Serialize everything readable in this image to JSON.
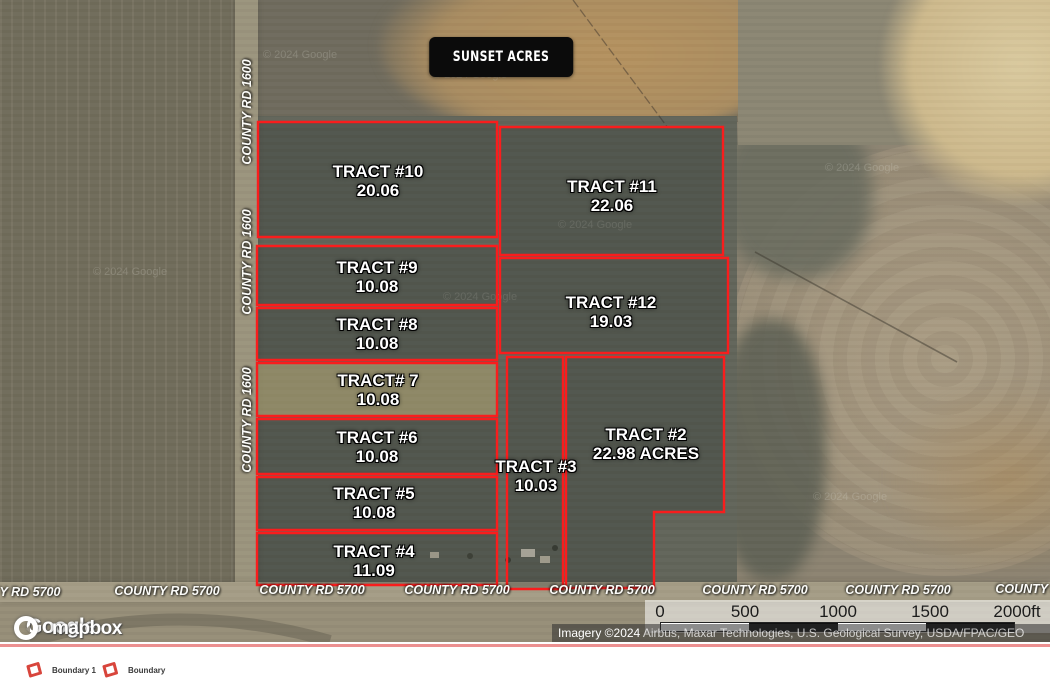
{
  "map": {
    "badge": "SUNSET ACRES",
    "boundary_color": "#f91d1d",
    "watermark_text": "© 2024 Google",
    "tracts": [
      {
        "name": "TRACT #10",
        "acres": "20.06",
        "cx": 378,
        "cy": 181,
        "shape": "258,122 497,122 497,237 258,237",
        "fill": "dark"
      },
      {
        "name": "TRACT #11",
        "acres": "22.06",
        "cx": 612,
        "cy": 196,
        "shape": "500,127 723,127 723,255 500,255",
        "fill": "dark"
      },
      {
        "name": "TRACT #9",
        "acres": "10.08",
        "cx": 377,
        "cy": 277,
        "shape": "257,246 497,246 497,305 257,305",
        "fill": "dark"
      },
      {
        "name": "TRACT #12",
        "acres": "19.03",
        "cx": 611,
        "cy": 312,
        "shape": "500,258 728,258 728,353 500,353",
        "fill": "dark"
      },
      {
        "name": "TRACT #8",
        "acres": "10.08",
        "cx": 377,
        "cy": 334,
        "shape": "257,308 497,308 497,360 257,360",
        "fill": "dark"
      },
      {
        "name": "TRACT# 7",
        "acres": "10.08",
        "cx": 378,
        "cy": 390,
        "shape": "257,363 497,363 497,416 257,416",
        "fill": "tan"
      },
      {
        "name": "TRACT #6",
        "acres": "10.08",
        "cx": 377,
        "cy": 447,
        "shape": "257,419 497,419 497,474 257,474",
        "fill": "dark"
      },
      {
        "name": "TRACT #2",
        "acres": "22.98 ACRES",
        "cx": 646,
        "cy": 444,
        "shape": "566,357 724,357 724,512 654,512 654,588 566,588",
        "fill": "dark"
      },
      {
        "name": "TRACT #3",
        "acres": "10.03",
        "cx": 536,
        "cy": 476,
        "shape": "507,357 563,357 563,589 507,589",
        "fill": "dark"
      },
      {
        "name": "TRACT #5",
        "acres": "10.08",
        "cx": 374,
        "cy": 503,
        "shape": "257,477 497,477 497,530 257,530",
        "fill": "dark"
      },
      {
        "name": "TRACT #4",
        "acres": "11.09",
        "cx": 374,
        "cy": 561,
        "shape": "257,533 497,533 497,585 257,585",
        "fill": "dark"
      }
    ],
    "roads": {
      "bottom_labels": [
        {
          "text": "Y RD 5700",
          "x": 30,
          "y": 592
        },
        {
          "text": "COUNTY RD 5700",
          "x": 167,
          "y": 591
        },
        {
          "text": "COUNTY RD 5700",
          "x": 312,
          "y": 590
        },
        {
          "text": "COUNTY RD 5700",
          "x": 457,
          "y": 590
        },
        {
          "text": "COUNTY RD 5700",
          "x": 602,
          "y": 590
        },
        {
          "text": "COUNTY RD 5700",
          "x": 755,
          "y": 590
        },
        {
          "text": "COUNTY RD 5700",
          "x": 898,
          "y": 590
        },
        {
          "text": "COUNTY RD 5700",
          "x": 1048,
          "y": 589
        }
      ],
      "left_labels": [
        {
          "text": "COUNTY RD 1600",
          "x": 247,
          "y": 112
        },
        {
          "text": "COUNTY RD 1600",
          "x": 247,
          "y": 262
        },
        {
          "text": "COUNTY RD 1600",
          "x": 247,
          "y": 420
        }
      ]
    },
    "watermarks": [
      {
        "x": 470,
        "y": 75
      },
      {
        "x": 300,
        "y": 55
      },
      {
        "x": 595,
        "y": 225
      },
      {
        "x": 480,
        "y": 297
      },
      {
        "x": 130,
        "y": 272
      },
      {
        "x": 862,
        "y": 168
      },
      {
        "x": 850,
        "y": 497
      }
    ],
    "scale_bar": {
      "ticks": [
        {
          "label": "0",
          "x": 660
        },
        {
          "label": "500",
          "x": 745
        },
        {
          "label": "1000",
          "x": 838
        },
        {
          "label": "1500",
          "x": 930
        },
        {
          "label": "2000ft",
          "x": 1017
        }
      ],
      "bar": {
        "x": 660,
        "width": 353
      }
    },
    "attribution": {
      "prefix": "Imagery ©2024",
      "sources": " Airbus, Maxar Technologies, U.S. Geological Survey, USDA/FPAC/GEO"
    },
    "logos": {
      "google": "Google",
      "mapbox": "mapbox"
    }
  },
  "legend": {
    "icon_color": "#d8453c",
    "items": [
      {
        "label": "Boundary 1",
        "x": 24
      },
      {
        "label": "Boundary",
        "x": 100
      }
    ]
  }
}
